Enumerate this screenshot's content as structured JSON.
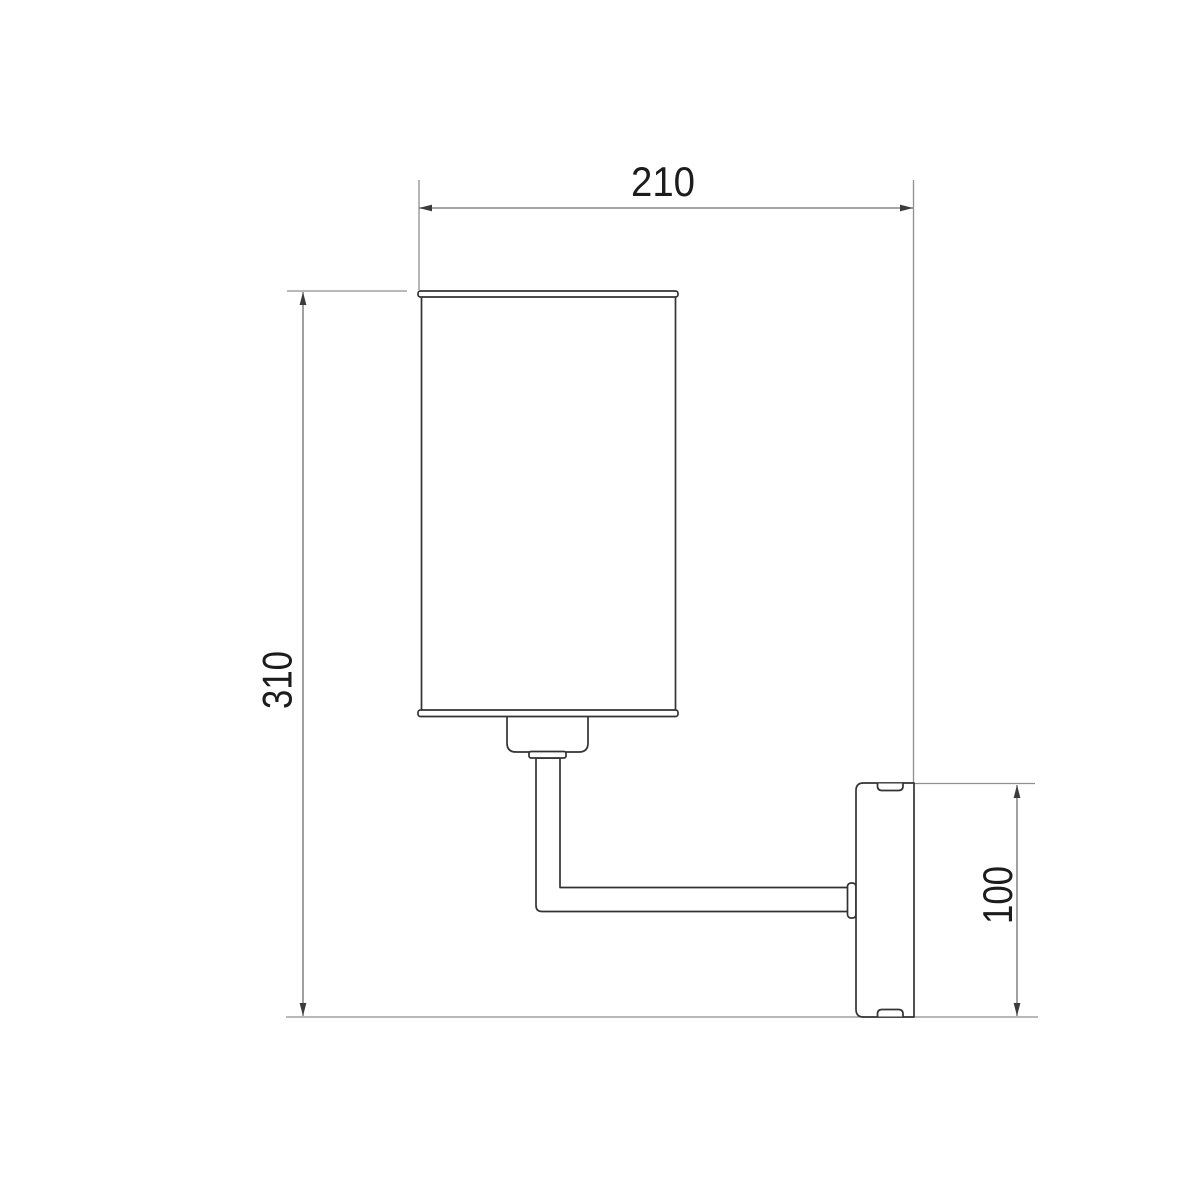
{
  "drawing": {
    "background": "#ffffff",
    "object_outline_color": "#333333",
    "dimension_line_color": "#6e6e6e",
    "extension_line_color": "#8f8f8f",
    "dimension_text_color": "#1c1c1c",
    "dimensions": {
      "shade_width": {
        "value": "210",
        "orientation": "horizontal",
        "position": "top"
      },
      "overall_height": {
        "value": "310",
        "orientation": "vertical",
        "position": "left"
      },
      "wall_plate_height": {
        "value": "100",
        "orientation": "vertical",
        "position": "right"
      }
    },
    "parts": [
      "shade-top-rim",
      "lamp-shade-body",
      "shade-bottom-rim",
      "lamp-socket",
      "socket-collar",
      "lamp-arm",
      "arm-flange",
      "wall-plate",
      "screw-slot-top",
      "screw-slot-bottom"
    ]
  }
}
